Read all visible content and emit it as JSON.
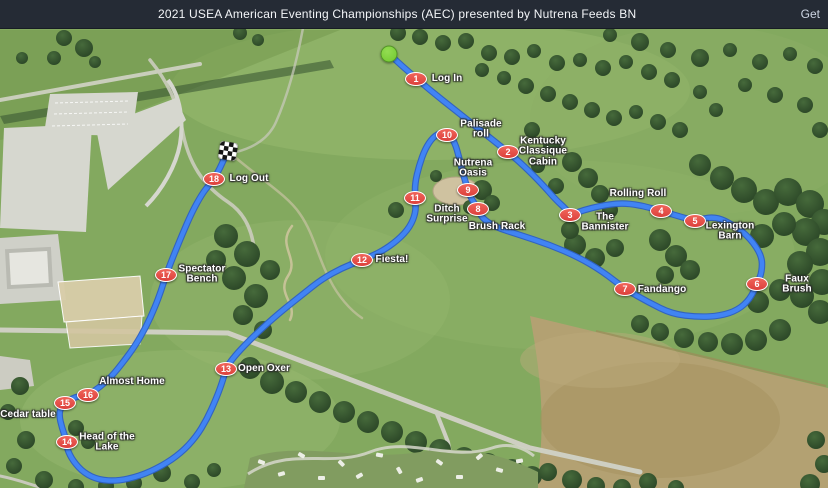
{
  "header": {
    "title": "2021 USEA American Eventing Championships (AEC) presented by Nutrena Feeds BN",
    "link_label": "Get"
  },
  "course": {
    "colors": {
      "route": "#4184f4",
      "route_casing": "#2d5fc4",
      "marker_red": "#e74c47",
      "start_green": "#7ed13c",
      "topbar": "#252b35"
    },
    "start": {
      "x": 389,
      "y": 54
    },
    "finish": {
      "x": 228,
      "y": 151
    },
    "fences": [
      {
        "num": "1",
        "x": 416,
        "y": 79,
        "label": "Log In",
        "label_x": 447,
        "label_y": 79
      },
      {
        "num": "2",
        "x": 508,
        "y": 152,
        "label": "Kentucky\nClassique\nCabin",
        "label_x": 543,
        "label_y": 152
      },
      {
        "num": "3",
        "x": 570,
        "y": 215,
        "label": "The\nBannister",
        "label_x": 605,
        "label_y": 223
      },
      {
        "num": "4",
        "x": 661,
        "y": 211,
        "label": "Rolling Roll",
        "label_x": 638,
        "label_y": 194
      },
      {
        "num": "5",
        "x": 695,
        "y": 221,
        "label": "Lexington\nBarn",
        "label_x": 730,
        "label_y": 232
      },
      {
        "num": "6",
        "x": 757,
        "y": 284,
        "label": "Faux Brush",
        "label_x": 797,
        "label_y": 285
      },
      {
        "num": "7",
        "x": 625,
        "y": 289,
        "label": "Fandango",
        "label_x": 662,
        "label_y": 290
      },
      {
        "num": "8",
        "x": 478,
        "y": 209,
        "label": "Brush Rack",
        "label_x": 497,
        "label_y": 227
      },
      {
        "num": "9",
        "x": 468,
        "y": 190,
        "label": "Nutrena\nOasis",
        "label_x": 473,
        "label_y": 169
      },
      {
        "num": "10",
        "x": 447,
        "y": 135,
        "label": "Palisade\nroll",
        "label_x": 481,
        "label_y": 130
      },
      {
        "num": "11",
        "x": 415,
        "y": 198,
        "label": "Ditch\nSurprise",
        "label_x": 447,
        "label_y": 215
      },
      {
        "num": "12",
        "x": 362,
        "y": 260,
        "label": "Fiesta!",
        "label_x": 392,
        "label_y": 260
      },
      {
        "num": "13",
        "x": 226,
        "y": 369,
        "label": "Open Oxer",
        "label_x": 264,
        "label_y": 369
      },
      {
        "num": "14",
        "x": 67,
        "y": 442,
        "label": "Head of the\nLake",
        "label_x": 107,
        "label_y": 443
      },
      {
        "num": "15",
        "x": 65,
        "y": 403,
        "label": "Cedar table",
        "label_x": 28,
        "label_y": 415
      },
      {
        "num": "16",
        "x": 88,
        "y": 395,
        "label": "Almost Home",
        "label_x": 132,
        "label_y": 382
      },
      {
        "num": "17",
        "x": 166,
        "y": 275,
        "label": "Spectator\nBench",
        "label_x": 202,
        "label_y": 275
      },
      {
        "num": "18",
        "x": 214,
        "y": 179,
        "label": "Log Out",
        "label_x": 249,
        "label_y": 179
      }
    ],
    "route_points": [
      [
        389,
        54
      ],
      [
        416,
        79
      ],
      [
        470,
        122
      ],
      [
        508,
        152
      ],
      [
        524,
        166
      ],
      [
        542,
        184
      ],
      [
        556,
        200
      ],
      [
        566,
        209
      ],
      [
        570,
        215
      ],
      [
        584,
        210
      ],
      [
        600,
        206
      ],
      [
        620,
        203
      ],
      [
        640,
        205
      ],
      [
        661,
        211
      ],
      [
        678,
        216
      ],
      [
        695,
        221
      ],
      [
        715,
        216
      ],
      [
        735,
        226
      ],
      [
        750,
        238
      ],
      [
        762,
        256
      ],
      [
        762,
        272
      ],
      [
        757,
        284
      ],
      [
        750,
        299
      ],
      [
        738,
        310
      ],
      [
        720,
        316
      ],
      [
        698,
        317
      ],
      [
        672,
        314
      ],
      [
        648,
        302
      ],
      [
        625,
        289
      ],
      [
        602,
        271
      ],
      [
        578,
        257
      ],
      [
        550,
        245
      ],
      [
        520,
        235
      ],
      [
        495,
        227
      ],
      [
        482,
        218
      ],
      [
        478,
        209
      ],
      [
        471,
        198
      ],
      [
        468,
        190
      ],
      [
        463,
        174
      ],
      [
        459,
        157
      ],
      [
        455,
        143
      ],
      [
        449,
        134
      ],
      [
        442,
        132
      ],
      [
        433,
        137
      ],
      [
        425,
        149
      ],
      [
        419,
        166
      ],
      [
        415,
        183
      ],
      [
        415,
        198
      ],
      [
        416,
        212
      ],
      [
        410,
        227
      ],
      [
        398,
        240
      ],
      [
        381,
        252
      ],
      [
        362,
        260
      ],
      [
        342,
        268
      ],
      [
        322,
        279
      ],
      [
        303,
        294
      ],
      [
        278,
        314
      ],
      [
        258,
        332
      ],
      [
        240,
        350
      ],
      [
        230,
        362
      ],
      [
        226,
        369
      ],
      [
        222,
        383
      ],
      [
        216,
        399
      ],
      [
        207,
        419
      ],
      [
        196,
        437
      ],
      [
        181,
        453
      ],
      [
        162,
        466
      ],
      [
        140,
        476
      ],
      [
        118,
        481
      ],
      [
        99,
        480
      ],
      [
        84,
        473
      ],
      [
        73,
        461
      ],
      [
        67,
        449
      ],
      [
        67,
        442
      ],
      [
        62,
        428
      ],
      [
        59,
        415
      ],
      [
        61,
        407
      ],
      [
        65,
        403
      ],
      [
        71,
        399
      ],
      [
        79,
        396
      ],
      [
        88,
        395
      ],
      [
        100,
        387
      ],
      [
        112,
        376
      ],
      [
        124,
        361
      ],
      [
        135,
        346
      ],
      [
        146,
        327
      ],
      [
        155,
        307
      ],
      [
        161,
        291
      ],
      [
        166,
        275
      ],
      [
        173,
        257
      ],
      [
        182,
        235
      ],
      [
        192,
        212
      ],
      [
        202,
        194
      ],
      [
        209,
        185
      ],
      [
        214,
        179
      ],
      [
        220,
        168
      ],
      [
        224,
        159
      ],
      [
        228,
        151
      ]
    ]
  }
}
